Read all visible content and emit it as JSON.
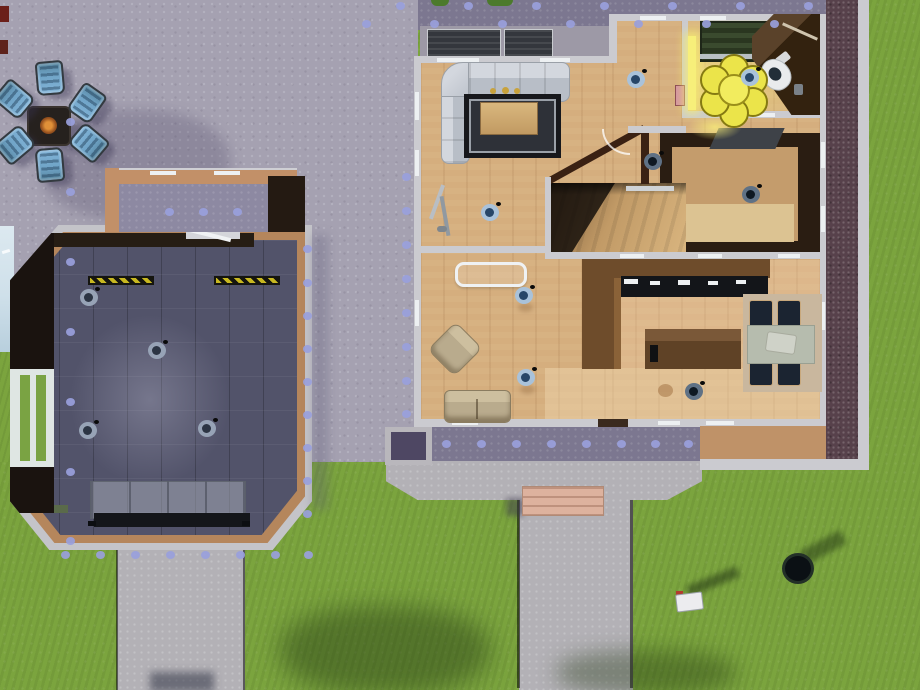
{
  "scene": {
    "view": "top-down life-simulation house build view",
    "lot_areas": [
      "backyard patio",
      "fire pit lounge",
      "gym outbuilding",
      "walled courtyard",
      "main house",
      "front yard"
    ]
  },
  "palette": {
    "grass": "#7BA43E",
    "patio": "#A5A1B1",
    "patioDeep": "#7C7790",
    "patioCourt": "#8D89A2",
    "path": "#B3B1B6",
    "dot": "#99A0DC",
    "wall": "#CBCBD0",
    "windowSlit": "#EDF0F2",
    "woodFloor": "#D5AE7E",
    "woodTrim": "#BF9268",
    "counterWood": "#6E4C2B",
    "applianceDark": "#131519",
    "gymFloor": "#52536A",
    "rugDark": "#17181C",
    "sofaGray": "#C6CAD2",
    "sofaTan": "#B9AB8D",
    "tableSage": "#B6BCAE",
    "chairNavy": "#1B2431",
    "rugBeige": "#C9B79E",
    "flowerYellow": "#EBE44A",
    "glowYellow": "#F7EF7A",
    "lampRing": "#A9C2DA",
    "lampCore": "#274668",
    "brick": "#57414B",
    "stepPink": "#DDB29E",
    "chairBlue": "#82B4D8",
    "hazardYellow": "#C8B820",
    "waterEdge": "#CFE0EA"
  },
  "fire_pit": {
    "name": "fire pit with lounge chairs",
    "chairs": [
      {
        "x": 36,
        "y": 61,
        "rot": 175
      },
      {
        "x": 0,
        "y": 82,
        "rot": 130
      },
      {
        "x": 73,
        "y": 86,
        "rot": 215
      },
      {
        "x": 1,
        "y": 128,
        "rot": 50
      },
      {
        "x": 75,
        "y": 126,
        "rot": 310
      },
      {
        "x": 36,
        "y": 148,
        "rot": 355
      }
    ]
  },
  "patio_dots": {
    "size": 9,
    "rows": [
      {
        "y": 2,
        "xs": [
          396,
          464,
          532,
          600,
          668,
          736,
          804
        ]
      },
      {
        "y": 20,
        "xs": [
          362,
          430,
          498,
          566,
          634,
          702,
          770
        ]
      },
      {
        "y": 440,
        "xs": [
          442,
          477,
          512,
          547,
          582,
          617,
          651,
          684
        ]
      },
      {
        "y": 551,
        "xs": [
          61,
          96,
          131,
          166,
          201,
          236,
          271,
          304
        ]
      },
      {
        "y": 208,
        "xs": [
          165,
          199,
          233
        ]
      }
    ],
    "cols": [
      {
        "x": 66,
        "ys": [
          118,
          188,
          258,
          328,
          398,
          468,
          537
        ]
      },
      {
        "x": 402,
        "ys": [
          173,
          207,
          241,
          275,
          309,
          343,
          377,
          410
        ]
      },
      {
        "x": 303,
        "ys": [
          245,
          279,
          312,
          345,
          378,
          411,
          444,
          477,
          510
        ]
      }
    ]
  },
  "ceiling_lamps": [
    {
      "x": 89,
      "y": 297,
      "v": "g"
    },
    {
      "x": 157,
      "y": 350,
      "v": "g"
    },
    {
      "x": 88,
      "y": 430,
      "v": "g"
    },
    {
      "x": 207,
      "y": 428,
      "v": "g"
    },
    {
      "x": 490,
      "y": 212,
      "v": "b"
    },
    {
      "x": 636,
      "y": 79,
      "v": "b"
    },
    {
      "x": 653,
      "y": 161,
      "v": "d"
    },
    {
      "x": 751,
      "y": 194,
      "v": "d"
    },
    {
      "x": 524,
      "y": 295,
      "v": "b"
    },
    {
      "x": 526,
      "y": 377,
      "v": "b"
    },
    {
      "x": 694,
      "y": 391,
      "v": "d"
    },
    {
      "x": 750,
      "y": 77,
      "v": "b"
    }
  ],
  "gym": {
    "name": "home gym outbuilding",
    "equipment": [
      "wall bars",
      "hazard floor strips",
      "workout bench rack",
      "west window wall"
    ]
  },
  "house": {
    "rooms": [
      {
        "name": "living room",
        "furniture": [
          "sectional sofa",
          "dark area rug",
          "coffee table",
          "floor lamps",
          "wall art"
        ]
      },
      {
        "name": "lounge",
        "furniture": [
          "glass table",
          "armchair",
          "loveseat"
        ]
      },
      {
        "name": "kitchen",
        "furniture": [
          "counter run with appliances",
          "kitchen island"
        ]
      },
      {
        "name": "dining room",
        "furniture": [
          "dining table",
          "four navy chairs",
          "beige rug",
          "centerpiece"
        ]
      },
      {
        "name": "bathroom",
        "furniture": [
          "shower stall",
          "toilet",
          "flower rug",
          "corner wardrobe",
          "wastebasket"
        ]
      },
      {
        "name": "den",
        "furniture": [
          "desk",
          "light rug"
        ]
      },
      {
        "name": "staircase",
        "furniture": [
          "wood stairs",
          "railing"
        ]
      }
    ]
  },
  "yard": {
    "objects": [
      "mailbox",
      "trash can",
      "front steps",
      "front walkway",
      "planter box",
      "fire pit"
    ]
  }
}
